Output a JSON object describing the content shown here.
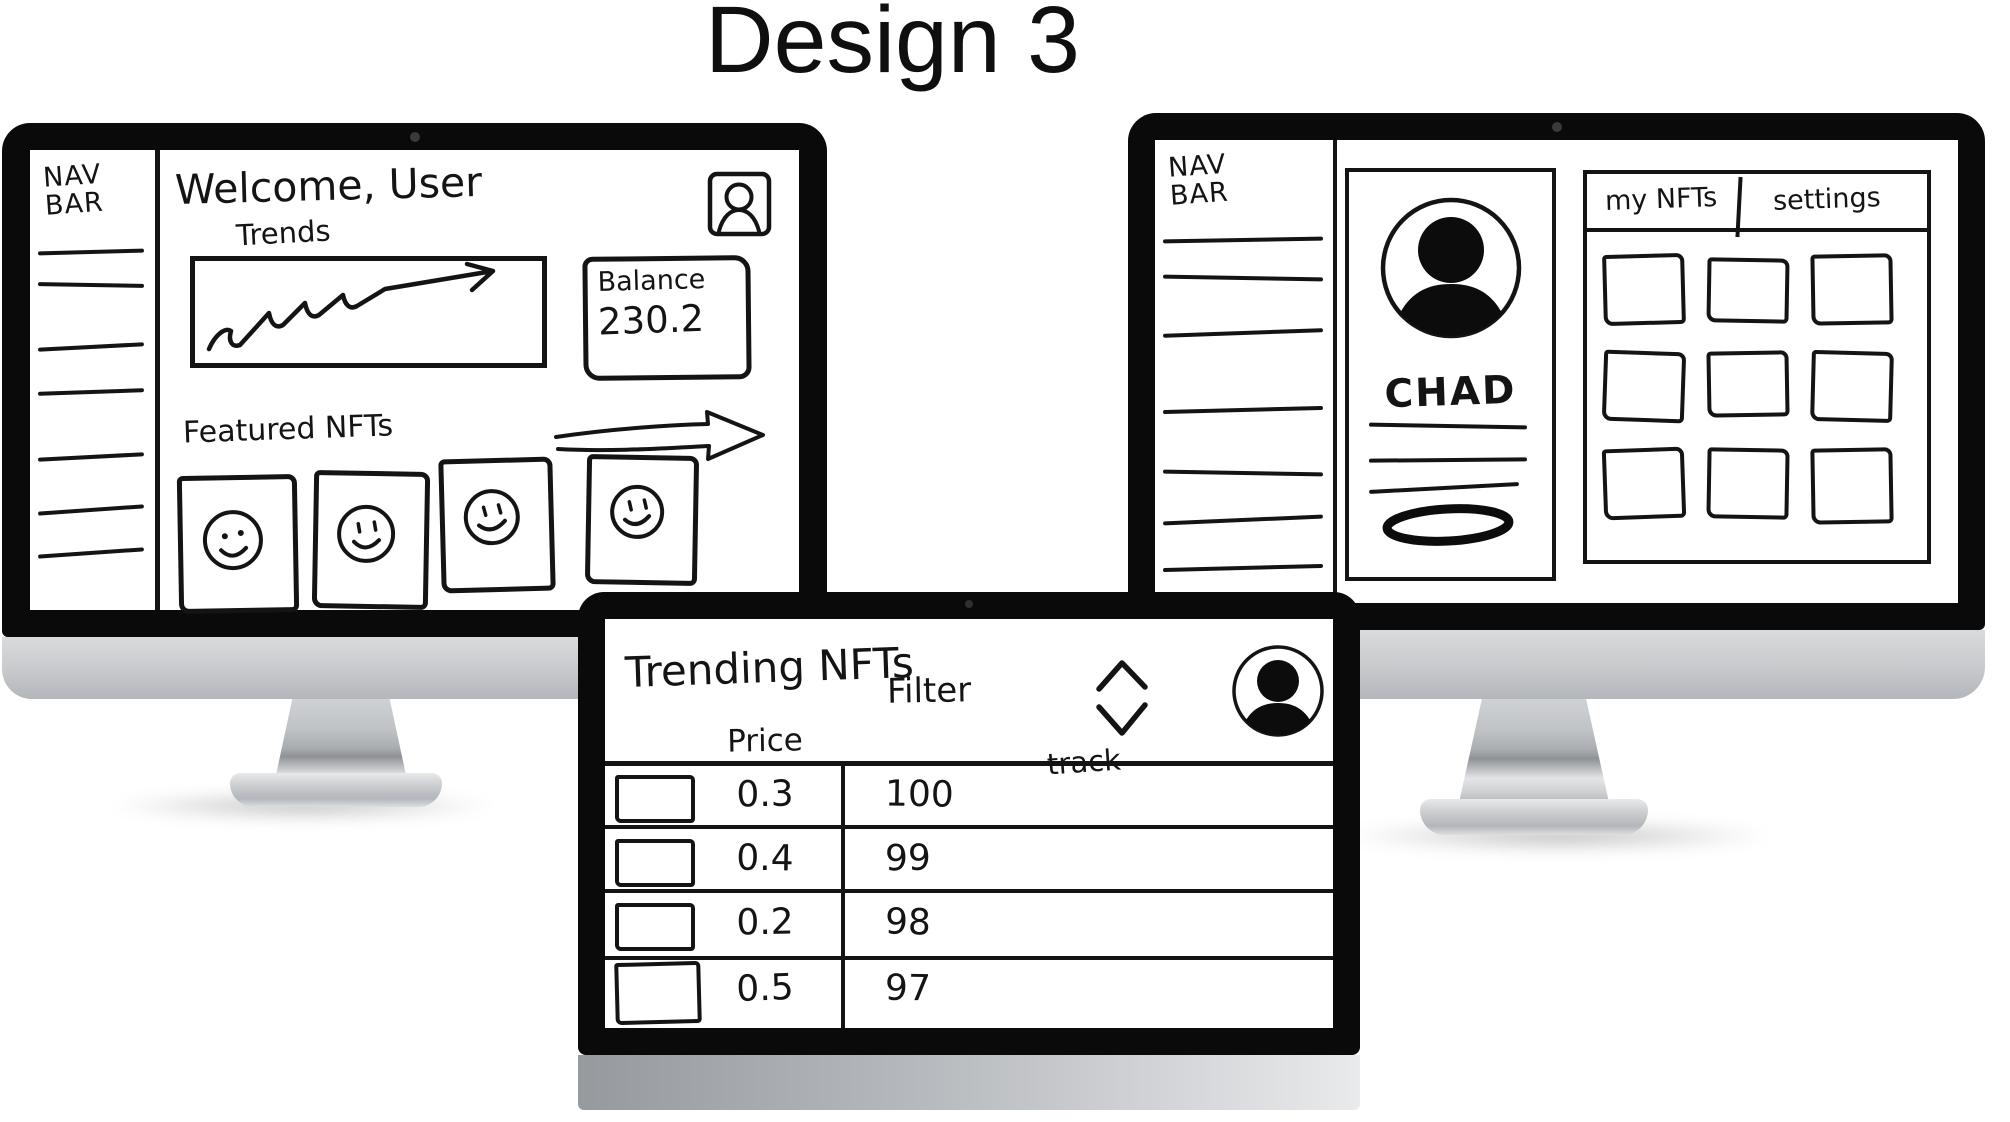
{
  "title": "Design 3",
  "theme": {
    "ink": "#141414",
    "bezel": "#0a0a0a",
    "chin_silver": "#c7c9cc",
    "paper": "#ffffff"
  },
  "dashboard": {
    "navbar_label": "NAV BAR",
    "welcome_heading": "Welcome, User",
    "avatar_icon": "user-avatar-icon",
    "trends_label": "Trends",
    "balance_label": "Balance",
    "balance_value": "230.2",
    "featured_label": "Featured NFTs",
    "featured_arrow_icon": "scroll-right-arrow-icon",
    "nft_card_count": 4
  },
  "profile": {
    "navbar_label": "NAV BAR",
    "avatar_icon": "profile-avatar-icon",
    "username": "CHAD",
    "bio_line_count": 3,
    "action_button_icon": "oval-button-sketch",
    "tabs": [
      {
        "label": "my NFTs"
      },
      {
        "label": "settings"
      }
    ],
    "nft_grid_count": 9
  },
  "trending": {
    "heading": "Trending NFTs",
    "filter_label": "Filter",
    "sort_icon": "sort-chevrons-icon",
    "avatar_icon": "user-avatar-icon",
    "columns": [
      "Price",
      "track"
    ],
    "rows": [
      {
        "price": "0.3",
        "rank": "100"
      },
      {
        "price": "0.4",
        "rank": "99"
      },
      {
        "price": "0.2",
        "rank": "98"
      },
      {
        "price": "0.5",
        "rank": "97"
      }
    ]
  }
}
